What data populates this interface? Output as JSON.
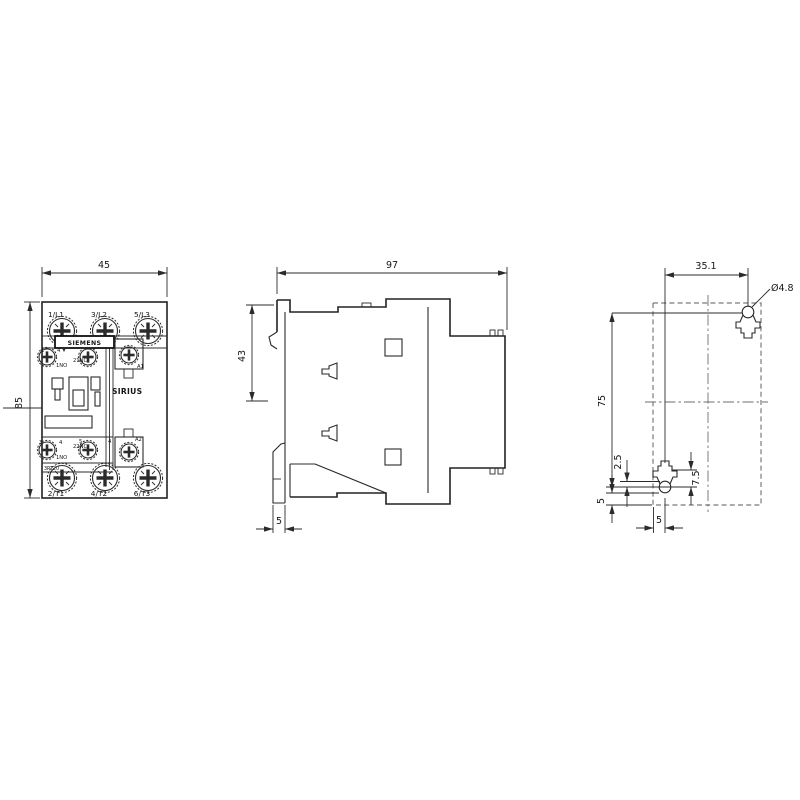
{
  "drawing": {
    "front": {
      "dim_width": "45",
      "dim_height": "85",
      "terminals_top": [
        "1/L1",
        "3/L2",
        "5/L3"
      ],
      "terminals_bottom": [
        "2/T1",
        "4/T2",
        "6/T3"
      ],
      "brand": "SIEMENS",
      "series": "SIRIUS",
      "product_code": "3RT20",
      "coil_top": "A1",
      "coil_bottom": "A2",
      "aux_top_num_1": "1",
      "aux_top_num_2": "4",
      "aux_top_label_1": "1NO",
      "aux_top_label_2": "21NC",
      "aux_bottom_num_1": "3",
      "aux_bottom_num_2": "4",
      "aux_bottom_num_3": "5",
      "aux_bottom_num_4": "4",
      "aux_bottom_label_1": "1NO",
      "aux_bottom_label_2": "22NC"
    },
    "side": {
      "dim_width": "97",
      "dim_height": "43",
      "dim_rail": "5"
    },
    "drill": {
      "dim_spacing_h": "35.1",
      "dim_hole": "Ø4.8",
      "dim_spacing_v": "75",
      "dim_r": "2.5",
      "dim_slot": "7.5",
      "dim_edge_left": "5",
      "dim_edge_bottom": "5"
    }
  }
}
